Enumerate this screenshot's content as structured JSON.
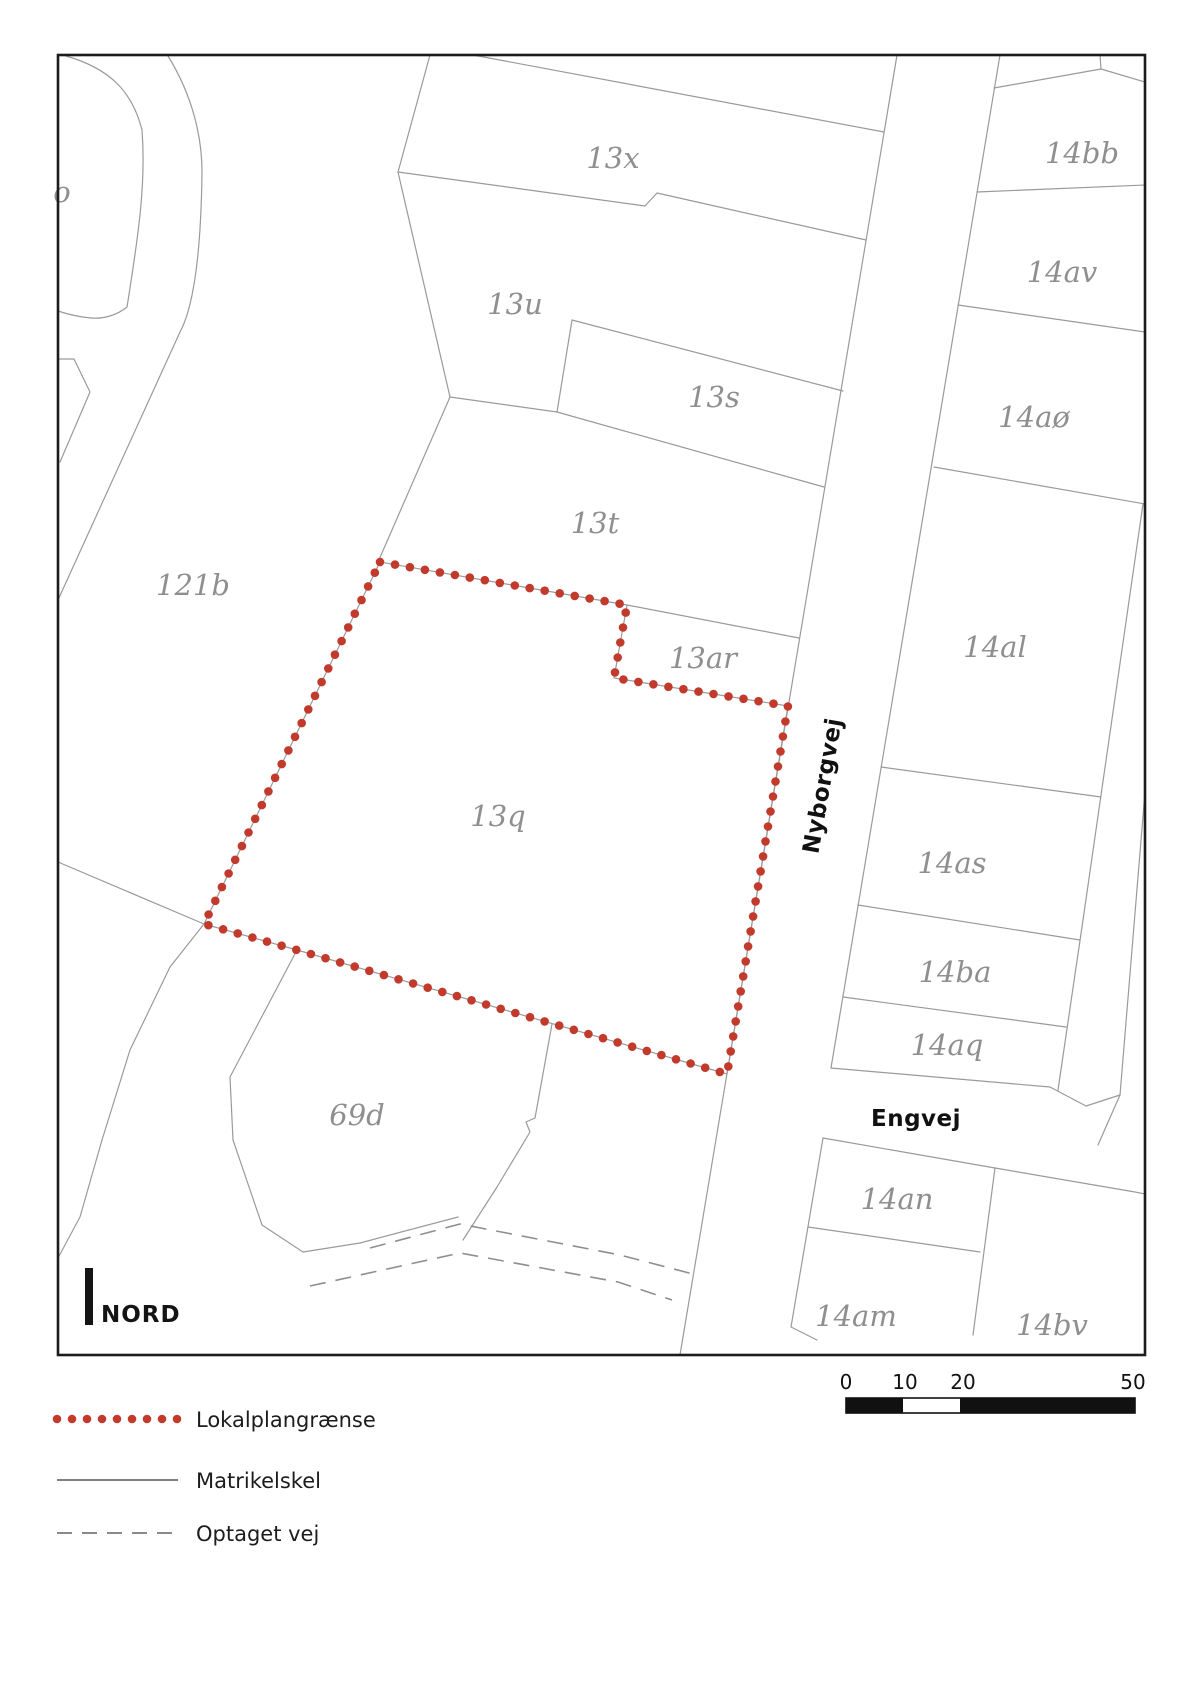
{
  "map": {
    "north_label": "NORD",
    "street_labels": [
      {
        "id": "nyborgvej",
        "text": "Nyborgvej",
        "x": 830,
        "y": 787,
        "rotate": -80
      },
      {
        "id": "engvej",
        "text": "Engvej",
        "x": 916,
        "y": 1126,
        "rotate": 0
      }
    ],
    "parcel_labels": [
      {
        "id": "o",
        "text": "o",
        "x": 62,
        "y": 202
      },
      {
        "id": "121b",
        "text": "121b",
        "x": 193,
        "y": 595
      },
      {
        "id": "13x",
        "text": "13x",
        "x": 613,
        "y": 168
      },
      {
        "id": "13u",
        "text": "13u",
        "x": 515,
        "y": 314
      },
      {
        "id": "13s",
        "text": "13s",
        "x": 714,
        "y": 407
      },
      {
        "id": "13t",
        "text": "13t",
        "x": 595,
        "y": 533
      },
      {
        "id": "13ar",
        "text": "13ar",
        "x": 703,
        "y": 668
      },
      {
        "id": "13q",
        "text": "13q",
        "x": 498,
        "y": 826
      },
      {
        "id": "69d",
        "text": "69d",
        "x": 357,
        "y": 1125
      },
      {
        "id": "14bb",
        "text": "14bb",
        "x": 1082,
        "y": 163
      },
      {
        "id": "14av",
        "text": "14av",
        "x": 1062,
        "y": 282
      },
      {
        "id": "14ao",
        "text": "14aø",
        "x": 1034,
        "y": 427
      },
      {
        "id": "14al",
        "text": "14al",
        "x": 995,
        "y": 657
      },
      {
        "id": "14as",
        "text": "14as",
        "x": 952,
        "y": 873
      },
      {
        "id": "14ba",
        "text": "14ba",
        "x": 955,
        "y": 982
      },
      {
        "id": "14aq",
        "text": "14aq",
        "x": 947,
        "y": 1055
      },
      {
        "id": "14an",
        "text": "14an",
        "x": 897,
        "y": 1209
      },
      {
        "id": "14am",
        "text": "14am",
        "x": 856,
        "y": 1326
      },
      {
        "id": "14bv",
        "text": "14bv",
        "x": 1052,
        "y": 1335
      }
    ],
    "boundary": {
      "name": "Lokalplangrænse",
      "color": "#c13a2c",
      "dot_radius": 4.3,
      "dot_spacing": 15.2,
      "vertices": [
        [
          380,
          562
        ],
        [
          627,
          605
        ],
        [
          614,
          678
        ],
        [
          788,
          706
        ],
        [
          727,
          1074
        ],
        [
          297,
          950
        ],
        [
          204,
          924
        ]
      ]
    }
  },
  "scalebar": {
    "ticks": [
      "0",
      "10",
      "20",
      "50"
    ],
    "tick_x": [
      846,
      905,
      963,
      1133
    ]
  },
  "legend": {
    "items": [
      {
        "key": "lokalplangraense",
        "label": "Lokalplangrænse"
      },
      {
        "key": "matrikelskel",
        "label": "Matrikelskel"
      },
      {
        "key": "optaget-vej",
        "label": "Optaget vej"
      }
    ]
  }
}
